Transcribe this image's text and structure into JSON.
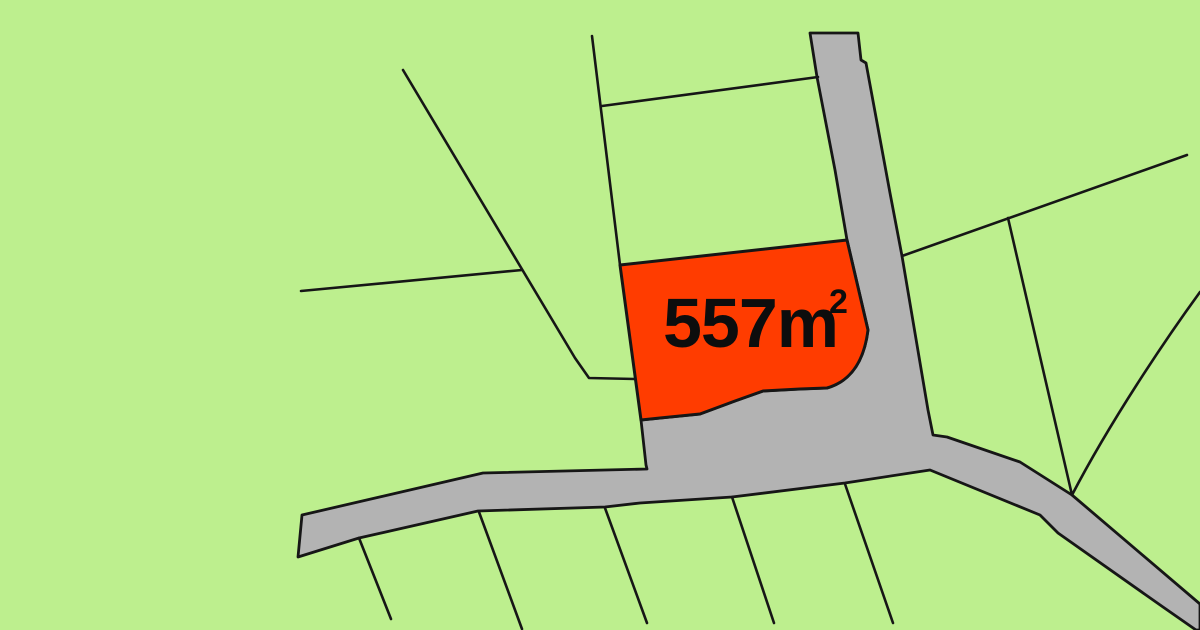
{
  "map": {
    "type": "cadastral-parcel-map",
    "area_label": {
      "value": "557m",
      "superscript": "2",
      "full": "557m²"
    },
    "colors": {
      "land": "#bdef8e",
      "road": "#b3b3b3",
      "boundary": "#161616",
      "highlight": "#ff3c00",
      "label": "#0d0d0d"
    },
    "geometry": {
      "viewbox": "0 0 1200 630",
      "road_path": "M810,33 L858,33 L861,60 L866,63 L890,193 L902,256 L928,410 L933,435 L947,437 L1020,462 L1072,495 L1200,604 L1200,630 L1196,630 L1163,607 L1058,533 L1040,515 L930,470 L845,483 L732,497 L640,503 L605,507 L478,511 L359,538 L298,557 L302,515 L483,473 L647,469 L646,465 L641,420 L700,414 L735,401 L763,391 L800,389 L827,388 Q862,378 868,330 L847,240 L835,170 L817,77 Z",
      "highlight_path": "M620,265 L847,240 L868,330 Q862,378 827,388 L800,389 L763,391 L735,401 L700,414 L660,418 L641,420 Z",
      "boundary_lines": [
        "M403,70 L575,358 L589,378 L635,379",
        "M301,291 L522,270",
        "M592,36 L620,265",
        "M602,106 L818,77",
        "M902,256 L1187,155",
        "M1008,218 L1072,495",
        "M1200,292 C1165,340 1110,422 1072,495",
        "M359,538 L391,619",
        "M479,512 L522,629",
        "M605,508 L647,623",
        "M732,497 L774,623",
        "M845,484 L893,623"
      ],
      "label_pos": {
        "x": 663,
        "y": 347,
        "font_size": 70,
        "sup_x": 829,
        "sup_y": 313,
        "sup_font_size": 34
      }
    }
  }
}
